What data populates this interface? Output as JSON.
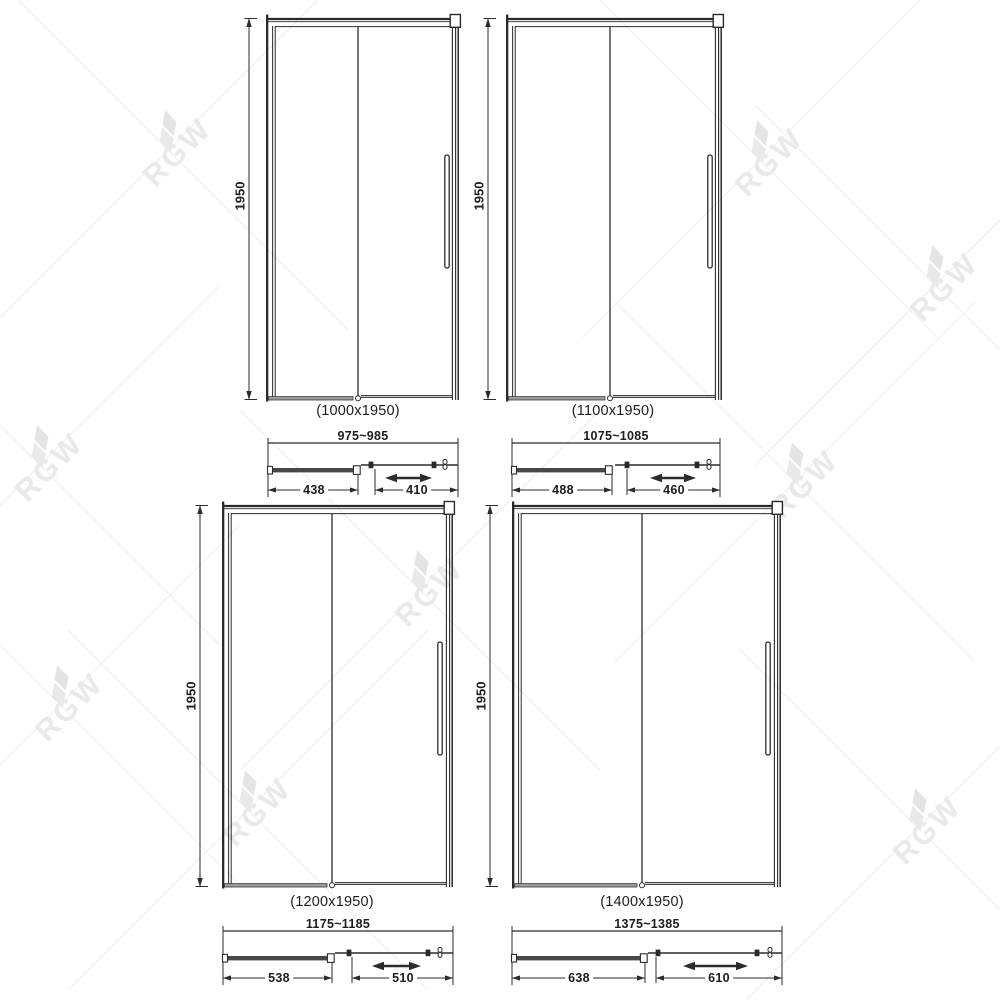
{
  "watermark": {
    "text": "RGW"
  },
  "doors": [
    {
      "size_label": "(1000x1950)",
      "height_label": "1950",
      "overall_width_label": "975~985",
      "fixed_panel_width_label": "438",
      "sliding_panel_width_label": "410"
    },
    {
      "size_label": "(1100x1950)",
      "height_label": "1950",
      "overall_width_label": "1075~1085",
      "fixed_panel_width_label": "488",
      "sliding_panel_width_label": "460"
    },
    {
      "size_label": "(1200x1950)",
      "height_label": "1950",
      "overall_width_label": "1175~1185",
      "fixed_panel_width_label": "538",
      "sliding_panel_width_label": "510"
    },
    {
      "size_label": "(1400x1950)",
      "height_label": "1950",
      "overall_width_label": "1375~1385",
      "fixed_panel_width_label": "638",
      "sliding_panel_width_label": "610"
    }
  ]
}
